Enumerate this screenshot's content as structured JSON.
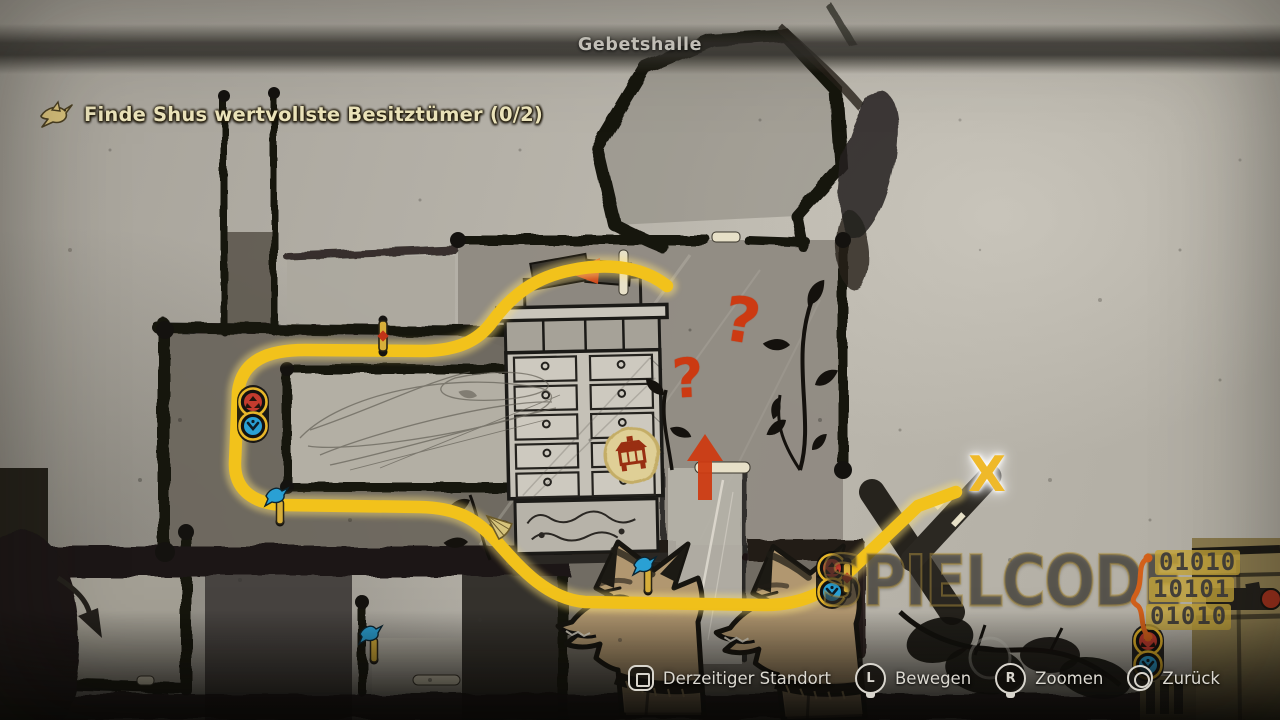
{
  "header": {
    "location_title": "Gebetshalle"
  },
  "quest": {
    "icon": "bird-icon",
    "objective": "Finde Shus wertvollste Besitztümer (0/2)"
  },
  "map": {
    "x_label": "X",
    "question_marks": [
      "?",
      "?"
    ],
    "icons": [
      "route-path",
      "destination-x-marker",
      "question-mark",
      "direction-up-arrow",
      "shrine-seal-icon",
      "twin-marker-red-artifact",
      "twin-marker-blue-bird",
      "door-marker-red-diamond",
      "door-marker-blue-bird",
      "fan-icon"
    ]
  },
  "controls": [
    {
      "button": "square",
      "label": "Derzeitiger Standort"
    },
    {
      "button": "L",
      "label": "Bewegen"
    },
    {
      "button": "R",
      "label": "Zoomen"
    },
    {
      "button": "circle",
      "label": "Zurück"
    }
  ],
  "watermark": {
    "text": "SPIELCODE",
    "binary_rows": [
      "01010",
      "10101",
      "01010"
    ]
  },
  "colors": {
    "route_yellow": "#f2c21b",
    "marker_red": "#c23b2e",
    "marker_blue": "#2aa0d4",
    "question_red": "#cc3a12",
    "x_yellow": "#efb92a",
    "door_gold": "#d7ae39"
  }
}
